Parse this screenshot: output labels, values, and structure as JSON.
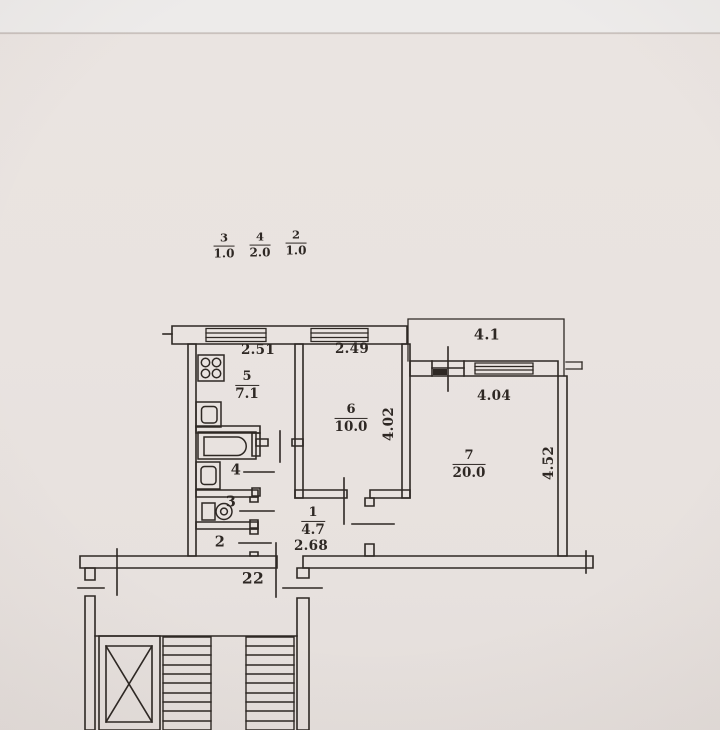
{
  "header_fractions": [
    {
      "numerator": "3",
      "denominator": "1.0"
    },
    {
      "numerator": "4",
      "denominator": "2.0"
    },
    {
      "numerator": "2",
      "denominator": "1.0"
    }
  ],
  "apartment": {
    "number": "22"
  },
  "rooms": {
    "kitchen": {
      "number": "5",
      "area": "7.1",
      "width": "2.51"
    },
    "living": {
      "number": "6",
      "area": "10.0",
      "width": "2.49",
      "depth": "4.02"
    },
    "bedroom": {
      "number": "7",
      "area": "20.0",
      "width": "4.04",
      "depth": "4.52"
    },
    "hallway": {
      "number": "1",
      "area": "4.7",
      "width": "2.68"
    },
    "bathroom": {
      "number": "4"
    },
    "toilet": {
      "number": "3"
    },
    "closet": {
      "number": "2"
    },
    "balcony": {
      "area": "4.1"
    }
  },
  "symbols": [
    "stove-icon",
    "sink-icon",
    "bathtub-icon",
    "toilet-icon",
    "elevator-icon",
    "stairs-icon",
    "window-icon",
    "door-tick-icon"
  ],
  "colors": {
    "paper": "#e9e3e0",
    "ink": "#2e2824"
  }
}
